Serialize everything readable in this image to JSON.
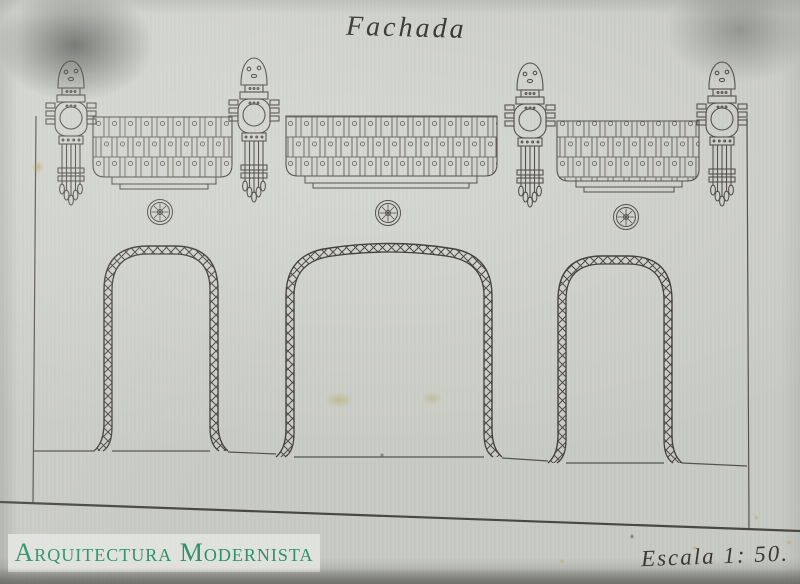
{
  "photo": {
    "description": "Photograph of a hand-drawn Modernista facade elevation on aged grey paper",
    "paper_color": "#c8cbc3",
    "ink_color": "#56524c"
  },
  "drawing": {
    "title": "Fachada",
    "scale_note": "Escala 1: 50.",
    "features": {
      "ornamental_pilasters": 4,
      "brick_frieze_panels": 3,
      "medallions": 3,
      "arched_openings": 3
    }
  },
  "watermark": {
    "text": "Arquitectura Modernista",
    "color": "#2e9266",
    "background": "#e2e3de"
  }
}
